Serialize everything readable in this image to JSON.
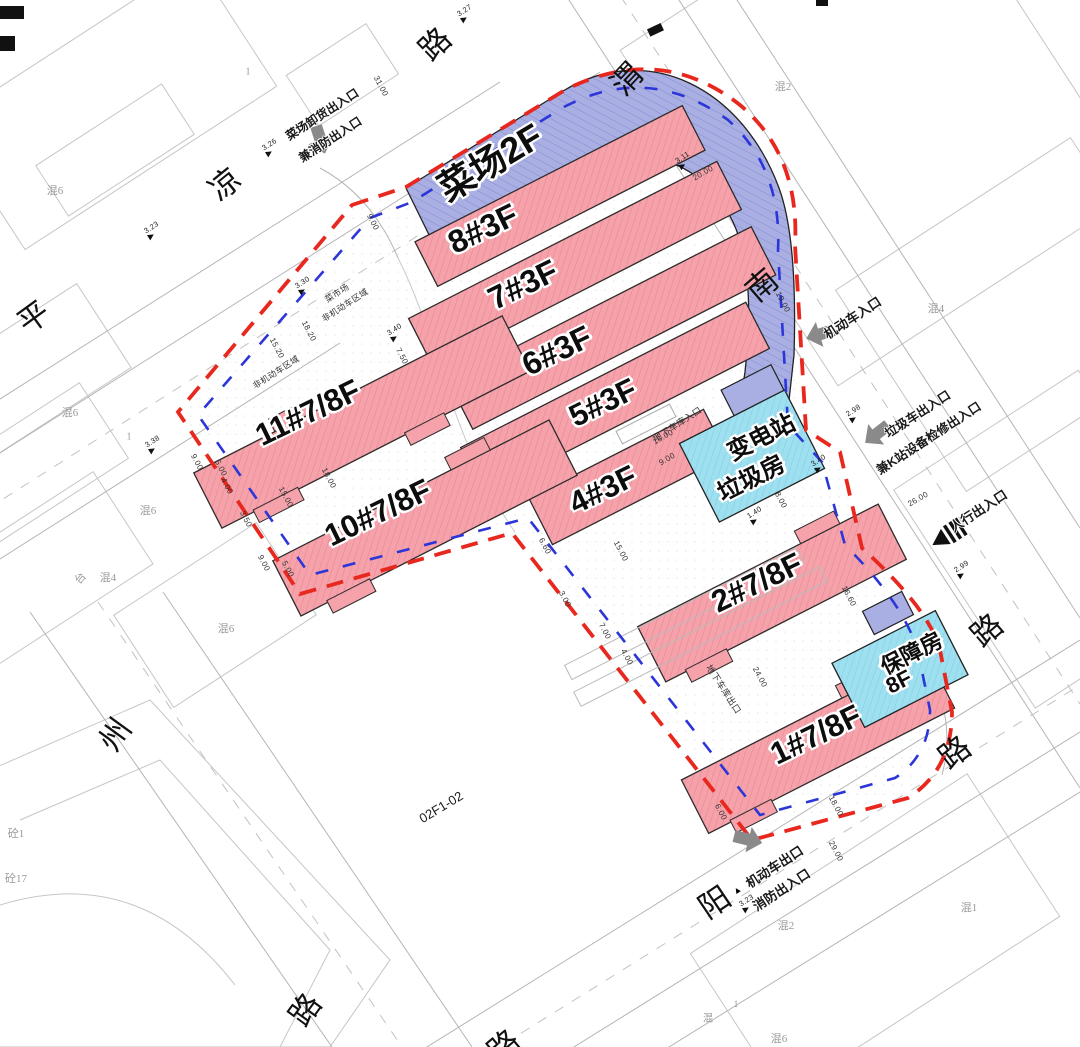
{
  "colors": {
    "site_boundary_red": "#e8281e",
    "setback_blue": "#2b35d8",
    "residential_pink": "#f5a2ab",
    "market_lavender": "#a9afe2",
    "utility_cyan": "#9fe0f0",
    "arrow_gray": "#8a8a8a"
  },
  "buildings": {
    "market": "菜场2F",
    "b8": "8#3F",
    "b7": "7#3F",
    "b6": "6#3F",
    "b5": "5#3F",
    "b4": "4#3F",
    "b11": "11#7/8F",
    "b10": "10#7/8F",
    "b2": "2#7/8F",
    "b1": "1#7/8F",
    "substation_line1": "变电站",
    "substation_line2": "垃圾房",
    "support_line1": "保障房",
    "support_line2": "8F"
  },
  "roads": {
    "pingliang": {
      "ping": "平",
      "liang": "凉",
      "lu": "路"
    },
    "weinan": {
      "wei": "渭",
      "nan": "南",
      "lu": "路"
    },
    "southwest": {
      "zhou": "州",
      "lu": "路"
    },
    "south": {
      "yang": "阳",
      "lu": "路",
      "lu_cut": "路"
    }
  },
  "entrances": {
    "market_unload_line1": "菜场卸货出入口",
    "market_unload_line2": "兼消防出入口",
    "vehicle_in": "机动车入口",
    "garbage_line1": "垃圾车出入口",
    "garbage_line2": "兼K站设备检修出入口",
    "pedestrian": "人行出入口",
    "vehicle_out_line1": "机动车出口",
    "vehicle_out_line2": "消防出入口",
    "triangle_mark": "▲",
    "garage_in": "地下车库入口",
    "garage_out": "地下车库出口"
  },
  "annotations": {
    "plot_code": "02F1-02",
    "market_zone_line1": "菜市场",
    "market_zone_line2": "非机动车区域",
    "nonmotor_zone": "非机动车区域"
  },
  "parcels": {
    "tl": "混6",
    "tln": "1",
    "tr": "混2",
    "r1": "混4",
    "l1": "混6",
    "l1n": "1",
    "l2": "混6",
    "l3": "混4",
    "l4": "混6",
    "lt": "台",
    "bl1": "砼1",
    "bl2": "砼17",
    "br1": "混2",
    "br2": "混1",
    "br3": "混6",
    "br4": "混",
    "br4n": "1"
  },
  "dimensions": {
    "d31": "31.00",
    "d20": "20.00",
    "d19": "19.00",
    "d26": "26.00",
    "d16": "16.00",
    "d9a": "9.00",
    "d166": "16.60",
    "d24": "24.00",
    "d18a": "18.00",
    "d29": "29.00",
    "d6": "6.00",
    "d18b": "18.00",
    "d15a": "15.00",
    "d152": "15.20",
    "d182": "18.20",
    "d9b": "9.00",
    "d75": "7.50",
    "d9c": "9.00",
    "d5a": "5.00",
    "d4a": "4.00",
    "d35": "3.50",
    "d8": "8.00",
    "d7": "7.00",
    "d4b": "4.00",
    "d3": "3.00",
    "d15b": "15.00",
    "d66": "6.60",
    "d5b": "5.00",
    "d9d": "9.00"
  },
  "elevations": {
    "e327": "3.27",
    "e326": "3.26",
    "e323a": "3.23",
    "e330": "3.30",
    "e311": "3.11",
    "e340a": "3.40",
    "e338": "3.38",
    "e298": "2.98",
    "e299": "2.99",
    "e340b": "3.40",
    "e323b": "3.23",
    "e140": "1.40"
  }
}
